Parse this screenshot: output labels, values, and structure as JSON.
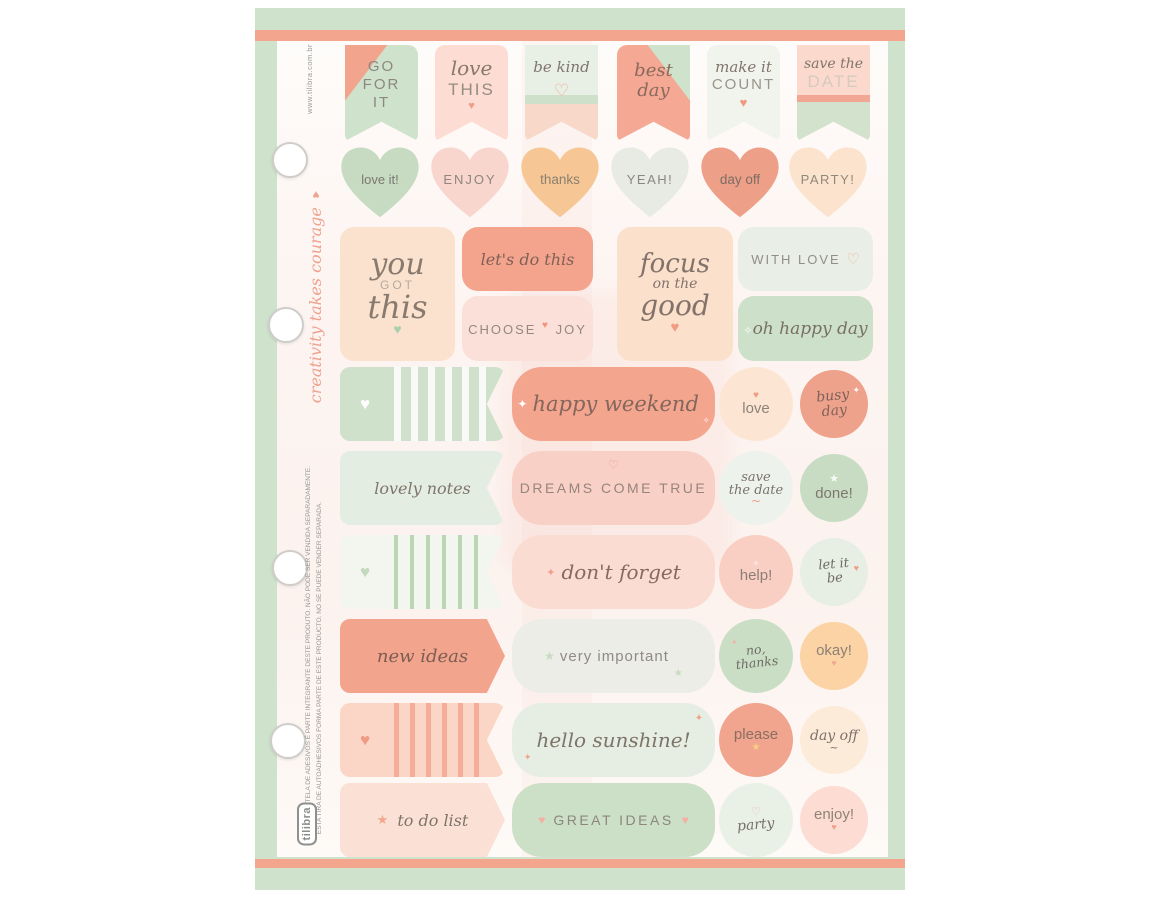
{
  "palette": {
    "mint_border": "#cfe2cc",
    "coral_stripe": "#f4a58e",
    "coral": "#f3a58e",
    "mint": "#cfe0cb",
    "peach": "#fbe2cf",
    "pink": "#f9d0c5",
    "cream": "#fce6d3",
    "orange": "#fbd3a5",
    "text_gray": "#8d8780"
  },
  "icons": {
    "heart": "♥",
    "heart_outline": "♡",
    "star": "★",
    "sparkle": "✦",
    "sparkle_small": "✧",
    "swirl": "~"
  },
  "side": {
    "website": "www.tilibra.com.br",
    "tagline": "creativity takes courage",
    "legal_line1": "ESTA CARTELA DE ADESIVOS É PARTE INTEGRANTE DESTE PRODUTO. NÃO PODE SER VENDIDA SEPARADAMENTE.",
    "legal_line2": "ESTA TIRA DE AUTOADHESIVOS FORMA PARTE DE ESTE PRODUCTO. NO SE PUEDE VENDER SEPARADA.",
    "logo": "tilibra"
  },
  "flags": [
    {
      "l1": "GO",
      "l2": "FOR",
      "l3": "IT"
    },
    {
      "script": "love",
      "caps": "THIS"
    },
    {
      "script": "be kind"
    },
    {
      "s1": "best",
      "s2": "day"
    },
    {
      "script": "make it",
      "caps": "COUNT"
    },
    {
      "script": "save the",
      "caps": "DATE"
    }
  ],
  "hearts": [
    "love it!",
    "ENJOY",
    "thanks",
    "YEAH!",
    "day off",
    "PARTY!"
  ],
  "quotes": {
    "you_got_this": {
      "s1": "you",
      "caps": "GOT",
      "s2": "this"
    },
    "lets_do_this": "let's do this",
    "choose_joy": {
      "w1": "CHOOSE",
      "w2": "JOY"
    },
    "focus": {
      "s1": "focus",
      "s2": "on the",
      "s3": "good"
    },
    "with_love": "WITH LOVE",
    "oh_happy_day": "oh happy day"
  },
  "strips": [
    {
      "pill": "happy weekend",
      "c1": "love",
      "c2a": "busy",
      "c2b": "day"
    },
    {
      "tag": "lovely notes",
      "pill": "DREAMS COME TRUE",
      "c1a": "save",
      "c1b": "the date",
      "c2": "done!"
    },
    {
      "pill": "don't forget",
      "c1": "help!",
      "c2a": "let it",
      "c2b": "be"
    },
    {
      "tag": "new ideas",
      "pill": "very important",
      "c1a": "no,",
      "c1b": "thanks",
      "c2": "okay!"
    },
    {
      "pill": "hello sunshine!",
      "c1": "please",
      "c2": "day off"
    },
    {
      "tag": "to do list",
      "pill": "GREAT IDEAS",
      "c1": "party",
      "c2": "enjoy!"
    }
  ]
}
